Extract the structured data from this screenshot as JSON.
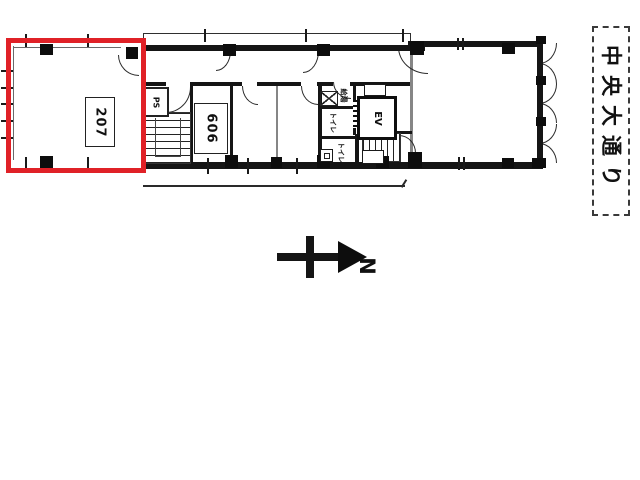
{
  "plan": {
    "unit207": {
      "label": "207"
    },
    "unit606": {
      "label": "606"
    },
    "elevator": {
      "label": "EV"
    },
    "pipe_space": {
      "label": "PS"
    },
    "kitchenette": {
      "label": "給湯"
    },
    "toilet_a": {
      "label": "トイレ"
    },
    "toilet_b": {
      "label": "トイレ"
    }
  },
  "street": {
    "name": "中央大通り"
  },
  "compass": {
    "north_label": "N"
  },
  "colors": {
    "highlight_red": "#e02127",
    "wall_black": "#151515"
  }
}
